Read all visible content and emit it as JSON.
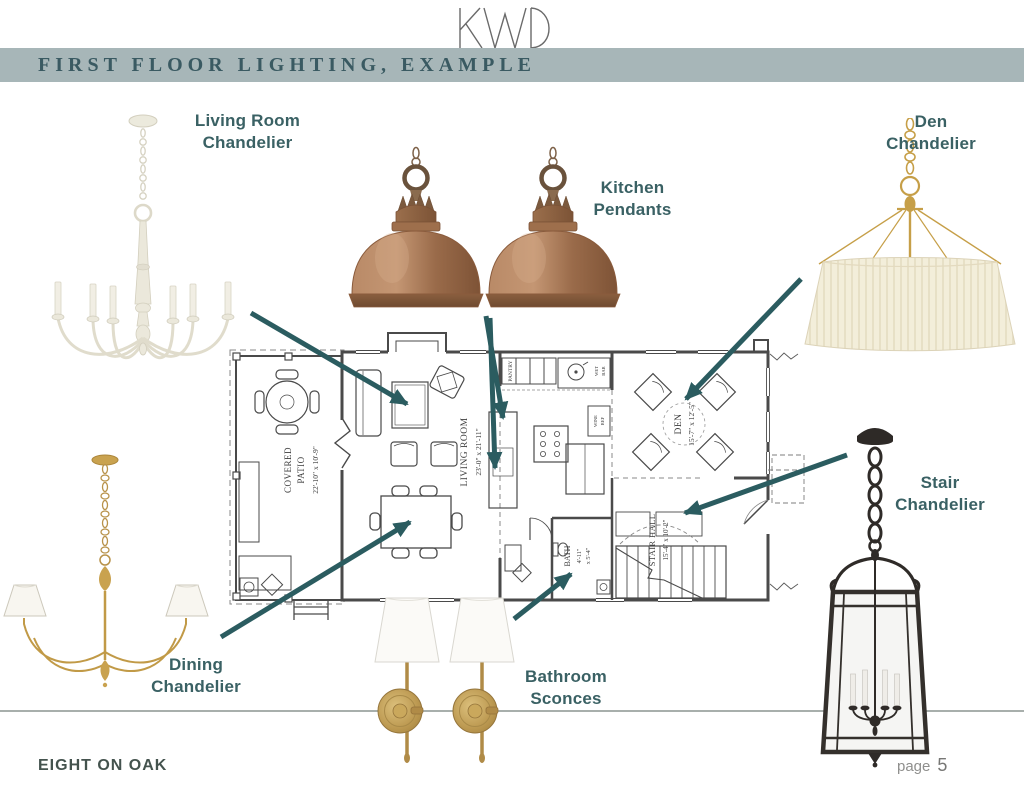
{
  "logo": {
    "text": "KWD"
  },
  "header": {
    "title": "FIRST FLOOR LIGHTING, EXAMPLE"
  },
  "annotations": {
    "living_room": {
      "line1": "Living Room",
      "line2": "Chandelier"
    },
    "kitchen": {
      "line1": "Kitchen",
      "line2": "Pendants"
    },
    "den": {
      "line1": "Den",
      "line2": "Chandelier"
    },
    "stair": {
      "line1": "Stair",
      "line2": "Chandelier"
    },
    "dining": {
      "line1": "Dining",
      "line2": "Chandelier"
    },
    "bathroom": {
      "line1": "Bathroom",
      "line2": "Sconces"
    }
  },
  "floorplan": {
    "covered_patio": {
      "name1": "COVERED",
      "name2": "PATIO",
      "dims": "22'-10\" x 10'-9\""
    },
    "living_room": {
      "name": "LIVING ROOM",
      "dims": "23'-0\" x 21'-11\""
    },
    "den": {
      "name": "DEN",
      "dims": "15'-7\" x 12'-5\""
    },
    "stair_hall": {
      "name": "STAIR HALL",
      "dims": "15'-4\" x 10'-2\""
    },
    "bath": {
      "name": "BATH",
      "dims1": "4'-11\"",
      "dims2": "x 5'-4\""
    },
    "pantry": {
      "name": "PANTRY"
    },
    "wet_bar": {
      "name1": "WET",
      "name2": "BAR"
    },
    "wine_ref": {
      "name1": "WINE",
      "name2": "REF"
    }
  },
  "footer": {
    "project": "EIGHT ON OAK",
    "page_label": "page",
    "page_number": "5"
  },
  "colors": {
    "header_band": "#a7b6b8",
    "header_text": "#3a5a62",
    "label_text": "#3a6164",
    "arrow": "#2b5c60",
    "copper": "#a4714f",
    "brass": "#c19a47",
    "cream_shade": "#f3eeda",
    "iron_black": "#2f2b28",
    "plan_line": "#4a4a4a"
  }
}
